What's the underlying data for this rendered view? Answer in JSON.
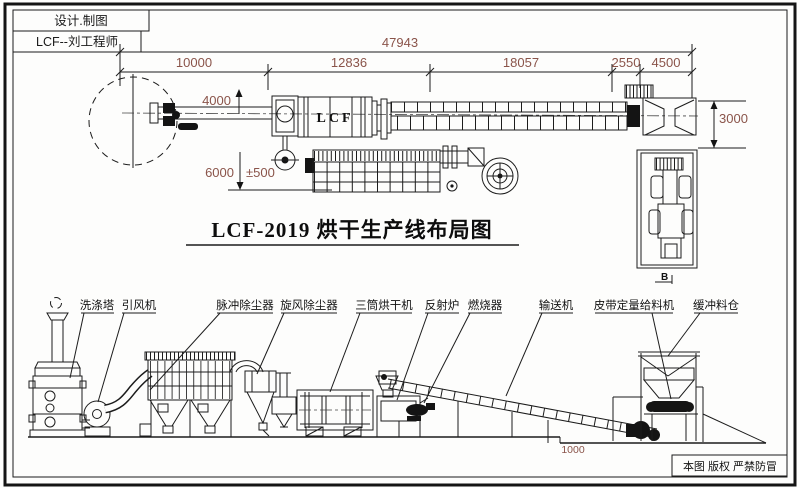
{
  "header": {
    "design_label": "设计.制图",
    "engineer_label": "LCF--刘工程师"
  },
  "title": {
    "text": "LCF-2019  烘干生产线布局图"
  },
  "footer": {
    "copyright": "本图 版权 严禁防冒"
  },
  "top_view": {
    "drum_label": "LCF",
    "section_mark": "B"
  },
  "dimensions": {
    "total_length": "47943",
    "segment_1": "10000",
    "segment_2": "12836",
    "segment_3": "18057",
    "segment_4": "2550",
    "segment_5": "4500",
    "feed_height": "4000",
    "dryer_height": "6000",
    "tolerance": "±500",
    "hopper_height": "3000",
    "ground_step": "1000"
  },
  "equipment_labels": {
    "washing_tower": "洗涤塔",
    "induced_draft_fan": "引风机",
    "pulse_dust_collector": "脉冲除尘器",
    "cyclone_dust_collector": "旋风除尘器",
    "triple_drum_dryer": "三筒烘干机",
    "reflection_furnace": "反射炉",
    "burner": "燃烧器",
    "conveyor": "输送机",
    "belt_feeder": "皮带定量给料机",
    "buffer_bin": "缓冲料仓"
  },
  "colors": {
    "line_color": "#1c1c1c",
    "dimension_text": "#8a544a",
    "background": "#fdfdfc"
  }
}
